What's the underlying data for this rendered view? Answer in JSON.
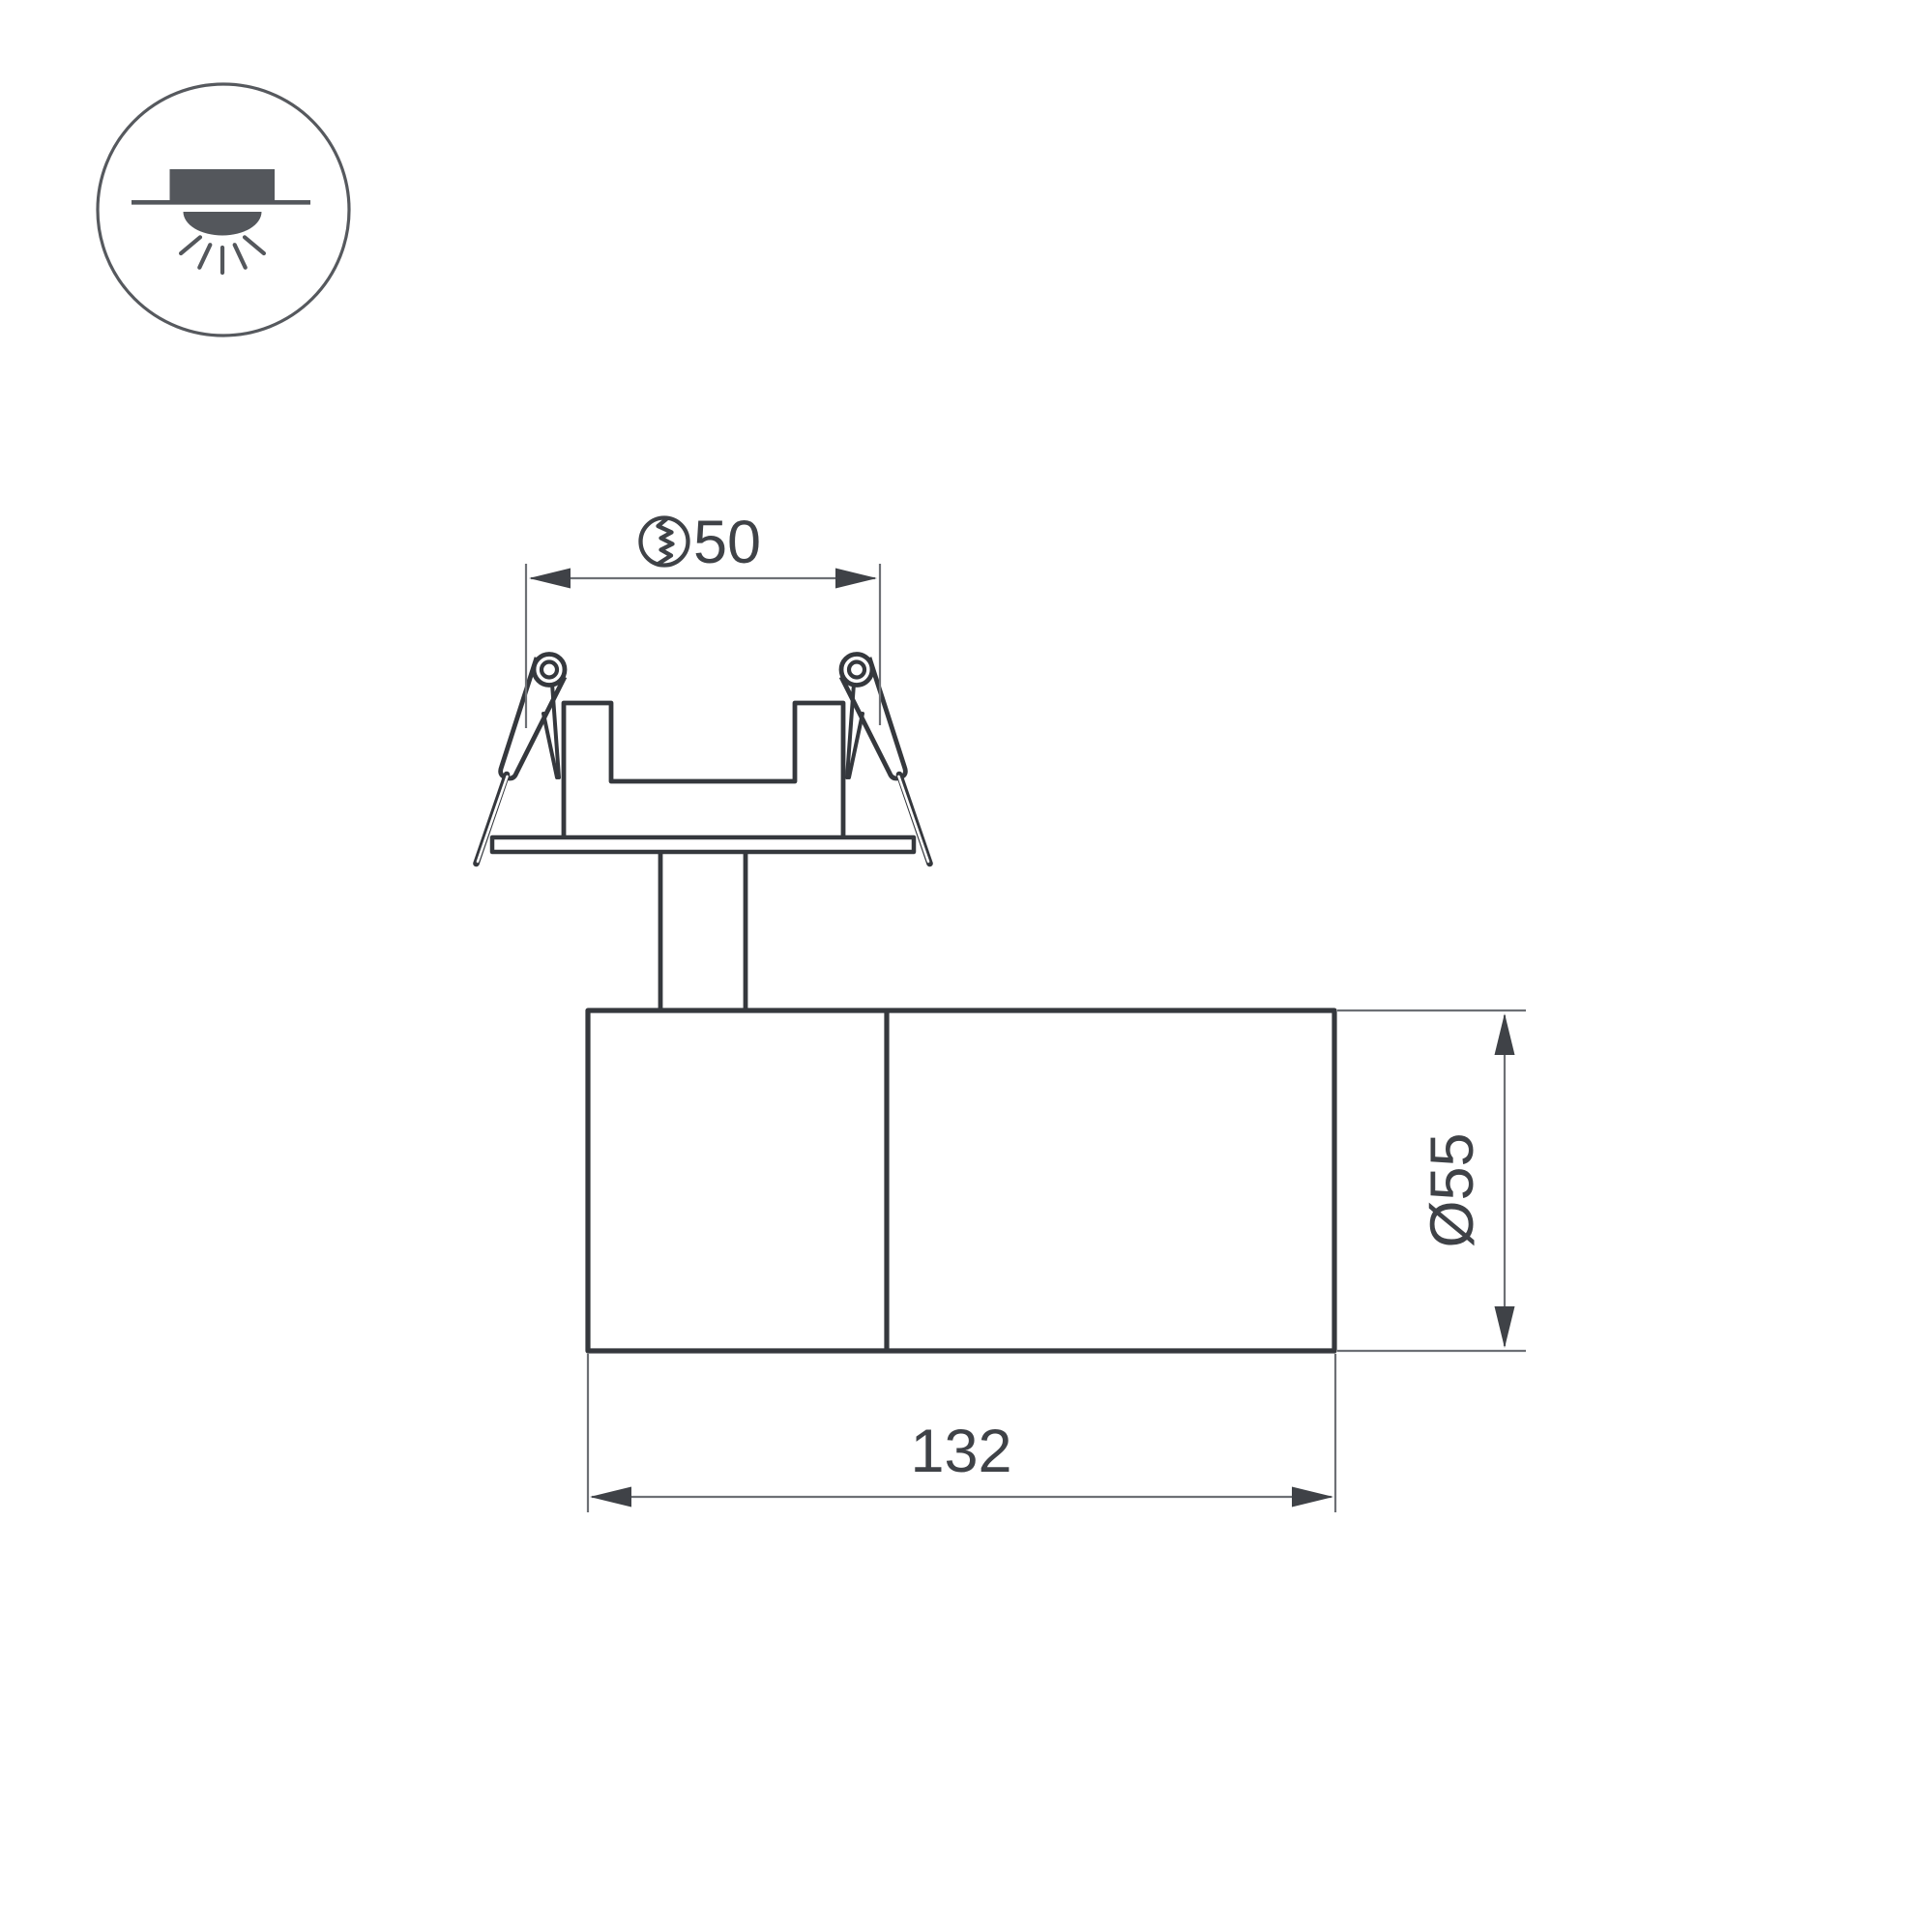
{
  "page": {
    "background": "#ffffff",
    "kind": "luminaire technical dimension drawing"
  },
  "colors": {
    "drawing_line": "#35383d",
    "dimension_line": "#6d7075",
    "text": "#3f4247",
    "badge_icon": "#54575c"
  },
  "badge": {
    "icon": "recessed-downlight-icon"
  },
  "drawing": {
    "views": {
      "top": "recessed mounting ring with two spring clips on stem",
      "body": "cylindrical spotlight body, two sections"
    }
  },
  "dimensions": {
    "cutout": {
      "label": "50",
      "symbol_icon": "hole-cut-icon"
    },
    "diameter": {
      "label": "Ø55"
    },
    "length": {
      "label": "132"
    }
  }
}
